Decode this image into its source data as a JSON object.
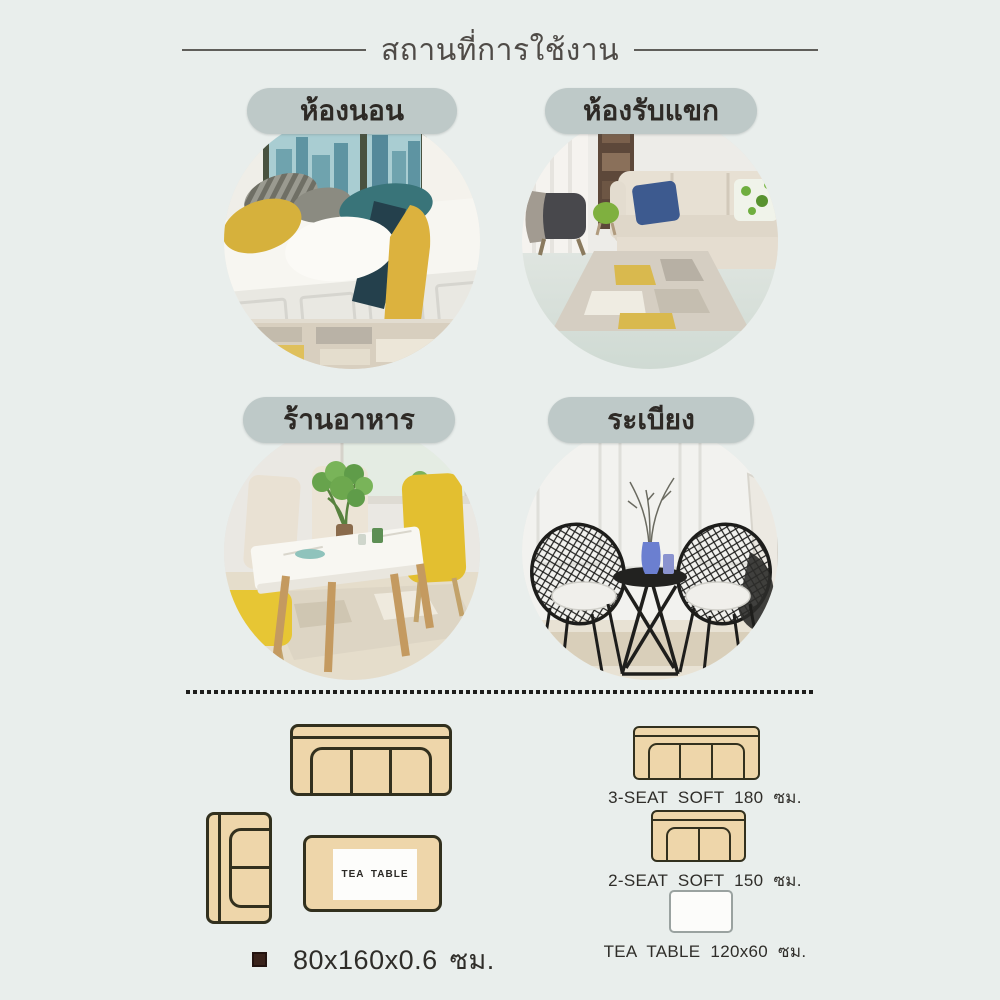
{
  "header": {
    "title": "สถานที่การใช้งาน"
  },
  "locations": [
    {
      "name": "bedroom",
      "label": "ห้องนอน"
    },
    {
      "name": "living-room",
      "label": "ห้องรับแขก"
    },
    {
      "name": "restaurant",
      "label": "ร้านอาหาร"
    },
    {
      "name": "balcony",
      "label": "ระเบียง"
    }
  ],
  "floor_plan": {
    "tea_table_label": "TEA TABLE",
    "rug_size_caption": "80x160x0.6 ซม."
  },
  "legend": [
    {
      "icon": "3-seat-sofa-icon",
      "label": "3-SEAT SOFT 180 ซม."
    },
    {
      "icon": "2-seat-sofa-icon",
      "label": "2-SEAT SOFT 150 ซม."
    },
    {
      "icon": "tea-table-icon",
      "label": "TEA TABLE 120x60 ซม."
    }
  ],
  "colors": {
    "background": "#e9eeec",
    "label_pill": "#bec9c8",
    "title_text": "#4f4b47",
    "sofa_diagram_fill": "#eed6aa",
    "sofa_diagram_outline": "#32301e",
    "bullet": "#3a231b"
  }
}
